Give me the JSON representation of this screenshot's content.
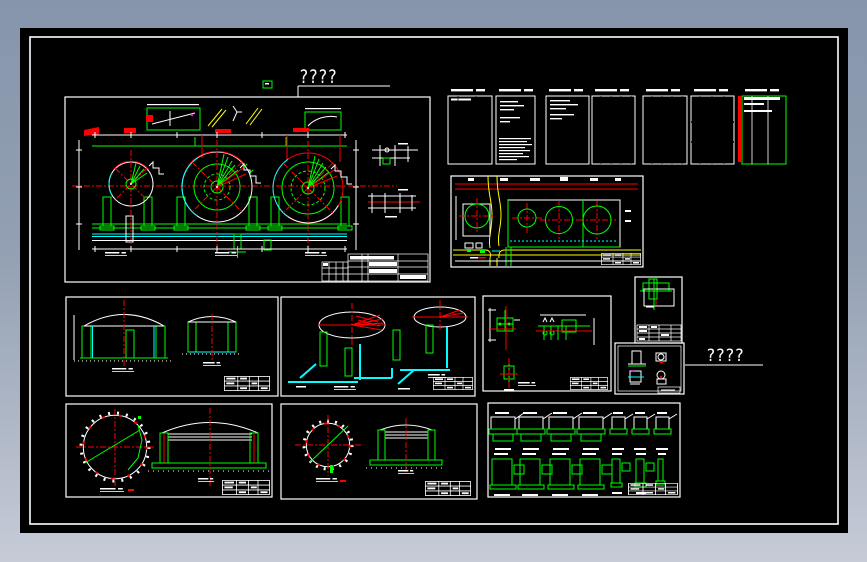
{
  "window": {
    "background_top": "#8695ab",
    "background_bottom": "#c6cbd7",
    "canvas_color": "#000000",
    "sheet_frame_color": "#ffffff"
  },
  "palette": {
    "line_white": "#ffffff",
    "line_green": "#00ff00",
    "line_red": "#ff0000",
    "line_cyan": "#00ffff",
    "line_yellow": "#ffff00",
    "line_magenta": "#ff00ff"
  },
  "labels": {
    "main_plan_title": "????",
    "detail_sheet_title": "????"
  }
}
